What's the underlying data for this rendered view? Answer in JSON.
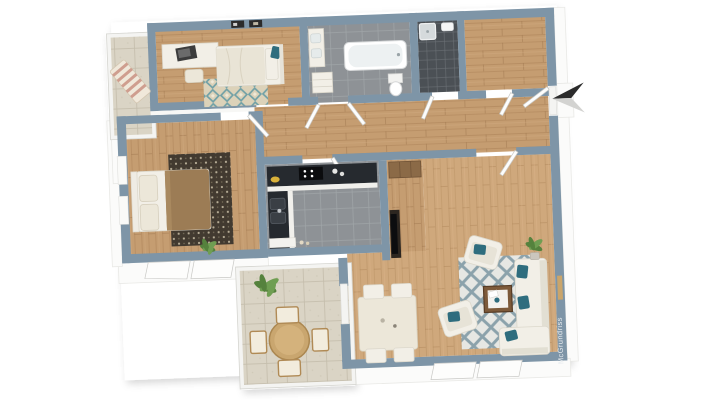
{
  "watermark": {
    "text": "McGrundriss"
  },
  "icons": {
    "entrance_arrow": "left-pointing-3d-arrow"
  },
  "palette": {
    "background": "#ffffff",
    "wall_top": "#7e95a7",
    "wall_face_white": "#fbfbfa",
    "wood_bedroom": "#c59d71",
    "wood_living": "#cfa87c",
    "bath_tile": "#8e9296",
    "shower_tile": "#4b5055",
    "balcony_tile": "#dad4c5",
    "kitchen_counter": "#262a2f",
    "teal_accent": "#2f6d7e",
    "master_rug_dark": "#423a30",
    "bed_blanket_brown": "#9c7c55",
    "outdoor_wood": "#c9a66f",
    "entrance_arrow_dark": "#2b2b2b"
  }
}
